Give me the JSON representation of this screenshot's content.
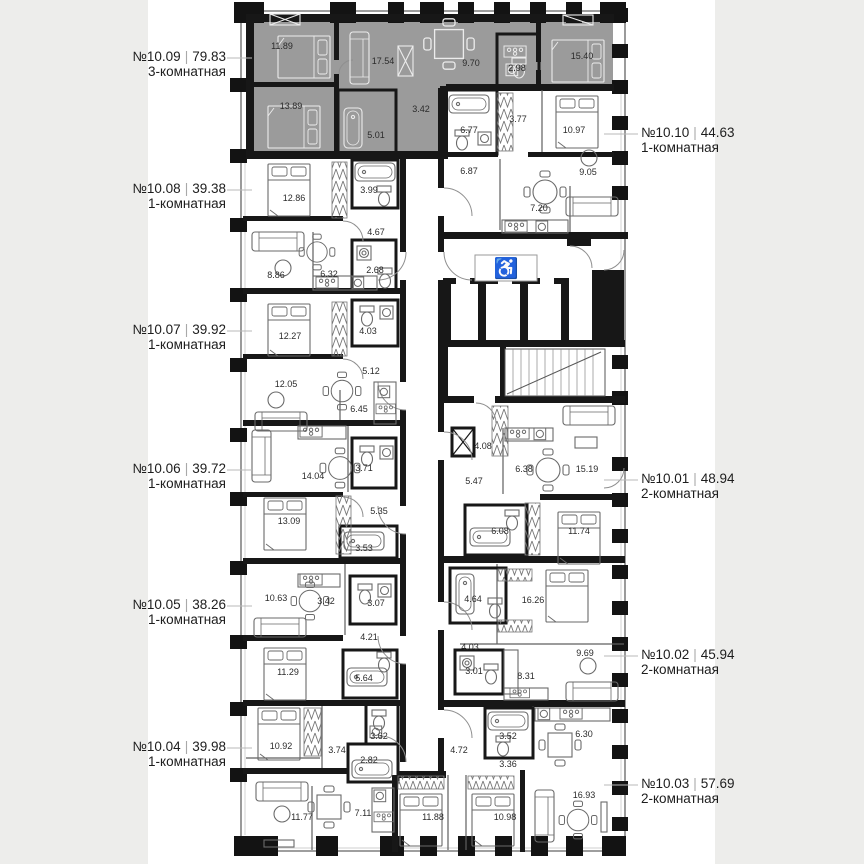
{
  "page": {
    "background": "#ededeb",
    "canvas_background": "#ffffff"
  },
  "plan": {
    "wall_color": "#171717",
    "highlight_fill": "#9b9b9b",
    "separator": "|",
    "signs": {
      "accessible": "♿"
    },
    "left_labels": [
      {
        "number": "№10.09",
        "area": "79.83",
        "type": "3-комнатная",
        "y": 49
      },
      {
        "number": "№10.08",
        "area": "39.38",
        "type": "1-комнатная",
        "y": 181
      },
      {
        "number": "№10.07",
        "area": "39.92",
        "type": "1-комнатная",
        "y": 322
      },
      {
        "number": "№10.06",
        "area": "39.72",
        "type": "1-комнатная",
        "y": 461
      },
      {
        "number": "№10.05",
        "area": "38.26",
        "type": "1-комнатная",
        "y": 597
      },
      {
        "number": "№10.04",
        "area": "39.98",
        "type": "1-комнатная",
        "y": 739
      }
    ],
    "right_labels": [
      {
        "number": "№10.10",
        "area": "44.63",
        "type": "1-комнатная",
        "y": 125
      },
      {
        "number": "№10.01",
        "area": "48.94",
        "type": "2-комнатная",
        "y": 471
      },
      {
        "number": "№10.02",
        "area": "45.94",
        "type": "2-комнатная",
        "y": 647
      },
      {
        "number": "№10.03",
        "area": "57.69",
        "type": "2-комнатная",
        "y": 776
      }
    ],
    "rooms": [
      {
        "v": "11.89",
        "x": 282,
        "y": 46
      },
      {
        "v": "17.54",
        "x": 383,
        "y": 61
      },
      {
        "v": "9.70",
        "x": 471,
        "y": 63
      },
      {
        "v": "2.98",
        "x": 517,
        "y": 68
      },
      {
        "v": "15.40",
        "x": 582,
        "y": 56
      },
      {
        "v": "13.89",
        "x": 291,
        "y": 106
      },
      {
        "v": "3.42",
        "x": 421,
        "y": 109
      },
      {
        "v": "5.01",
        "x": 376,
        "y": 135
      },
      {
        "v": "6.77",
        "x": 469,
        "y": 130
      },
      {
        "v": "3.77",
        "x": 518,
        "y": 119
      },
      {
        "v": "10.97",
        "x": 574,
        "y": 130
      },
      {
        "v": "6.87",
        "x": 469,
        "y": 171
      },
      {
        "v": "9.05",
        "x": 588,
        "y": 172
      },
      {
        "v": "7.20",
        "x": 539,
        "y": 208
      },
      {
        "v": "12.86",
        "x": 294,
        "y": 198
      },
      {
        "v": "3.99",
        "x": 369,
        "y": 190
      },
      {
        "v": "4.67",
        "x": 376,
        "y": 232
      },
      {
        "v": "8.86",
        "x": 276,
        "y": 275
      },
      {
        "v": "6.32",
        "x": 329,
        "y": 274
      },
      {
        "v": "2.68",
        "x": 375,
        "y": 270
      },
      {
        "v": "12.27",
        "x": 290,
        "y": 336
      },
      {
        "v": "4.03",
        "x": 368,
        "y": 331
      },
      {
        "v": "5.12",
        "x": 371,
        "y": 371
      },
      {
        "v": "12.05",
        "x": 286,
        "y": 384
      },
      {
        "v": "6.45",
        "x": 359,
        "y": 409
      },
      {
        "v": "14.04",
        "x": 313,
        "y": 476
      },
      {
        "v": "3.71",
        "x": 364,
        "y": 468
      },
      {
        "v": "13.09",
        "x": 289,
        "y": 521
      },
      {
        "v": "5.35",
        "x": 379,
        "y": 511
      },
      {
        "v": "3.53",
        "x": 364,
        "y": 548
      },
      {
        "v": "10.63",
        "x": 276,
        "y": 598
      },
      {
        "v": "3.42",
        "x": 326,
        "y": 601
      },
      {
        "v": "3.07",
        "x": 376,
        "y": 603
      },
      {
        "v": "4.21",
        "x": 369,
        "y": 637
      },
      {
        "v": "11.29",
        "x": 288,
        "y": 672
      },
      {
        "v": "5.64",
        "x": 364,
        "y": 678
      },
      {
        "v": "10.92",
        "x": 281,
        "y": 746
      },
      {
        "v": "3.74",
        "x": 337,
        "y": 750
      },
      {
        "v": "3.62",
        "x": 379,
        "y": 736
      },
      {
        "v": "2.82",
        "x": 369,
        "y": 760
      },
      {
        "v": "11.77",
        "x": 302,
        "y": 817
      },
      {
        "v": "7.11",
        "x": 363,
        "y": 813
      },
      {
        "v": "4.08",
        "x": 483,
        "y": 446
      },
      {
        "v": "6.38",
        "x": 524,
        "y": 469
      },
      {
        "v": "15.19",
        "x": 587,
        "y": 469
      },
      {
        "v": "5.47",
        "x": 474,
        "y": 481
      },
      {
        "v": "6.08",
        "x": 500,
        "y": 531
      },
      {
        "v": "11.74",
        "x": 579,
        "y": 531
      },
      {
        "v": "4.64",
        "x": 473,
        "y": 599
      },
      {
        "v": "16.26",
        "x": 533,
        "y": 600
      },
      {
        "v": "4.03",
        "x": 470,
        "y": 647
      },
      {
        "v": "9.69",
        "x": 585,
        "y": 653
      },
      {
        "v": "3.01",
        "x": 474,
        "y": 671
      },
      {
        "v": "8.31",
        "x": 526,
        "y": 676
      },
      {
        "v": "3.52",
        "x": 508,
        "y": 736
      },
      {
        "v": "6.30",
        "x": 584,
        "y": 734
      },
      {
        "v": "4.72",
        "x": 459,
        "y": 750
      },
      {
        "v": "3.36",
        "x": 508,
        "y": 764
      },
      {
        "v": "16.93",
        "x": 584,
        "y": 795
      },
      {
        "v": "11.88",
        "x": 433,
        "y": 817
      },
      {
        "v": "10.98",
        "x": 505,
        "y": 817
      }
    ]
  }
}
